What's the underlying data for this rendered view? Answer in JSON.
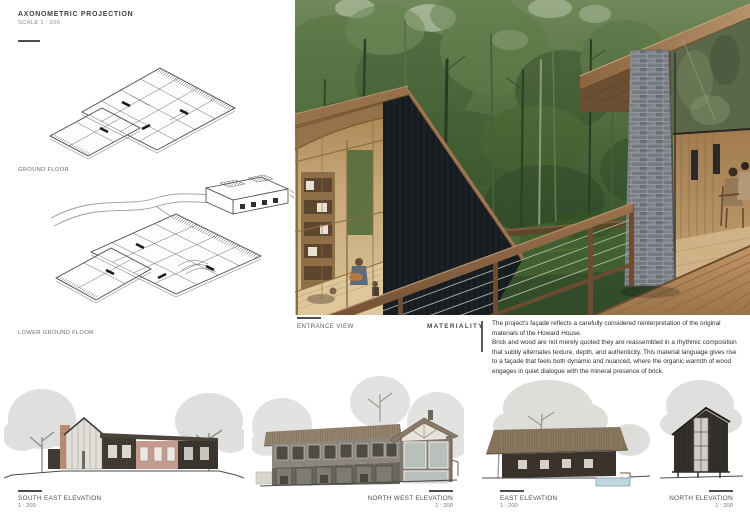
{
  "header": {
    "title": "AXONOMETRIC PROJECTION",
    "subtitle": "SCALE 1 : 200"
  },
  "axonometric": {
    "ground_label": "GROUND FLOOR",
    "lower_label": "LOWER GROUND FLOOR"
  },
  "entrance": {
    "label": "ENTRANCE VIEW"
  },
  "materiality": {
    "heading": "MATERIALITY",
    "p1": "The project's façade reflects a carefully considered reinterpretation of the original materials of the Howard House.",
    "p2": "Brick and wood are not merely quoted they are reassembled in a rhythmic composition that subtly alternates texture, depth, and authenticity. This material language gives rise to a façade that feels both dynamic and nuanced, where the organic warmth of wood engages in quiet dialogue with the mineral presence of brick."
  },
  "elevations": [
    {
      "label": "SOUTH EAST ELEVATION",
      "scale": "1 : 200"
    },
    {
      "label": "NORTH WEST ELEVATION",
      "scale": "1 : 200"
    },
    {
      "label": "EAST ELEVATION",
      "scale": "1 : 200"
    },
    {
      "label": "NORTH ELEVATION",
      "scale": "1 : 200"
    }
  ],
  "palette": {
    "forest_green": "#47643a",
    "charred_timber": "#171c21",
    "warm_timber": "#96714a",
    "brick_grey": "#7b8085",
    "brick_pink": "#c59a90",
    "paper_white": "#ffffff",
    "line_grey": "#4d4d4d"
  }
}
